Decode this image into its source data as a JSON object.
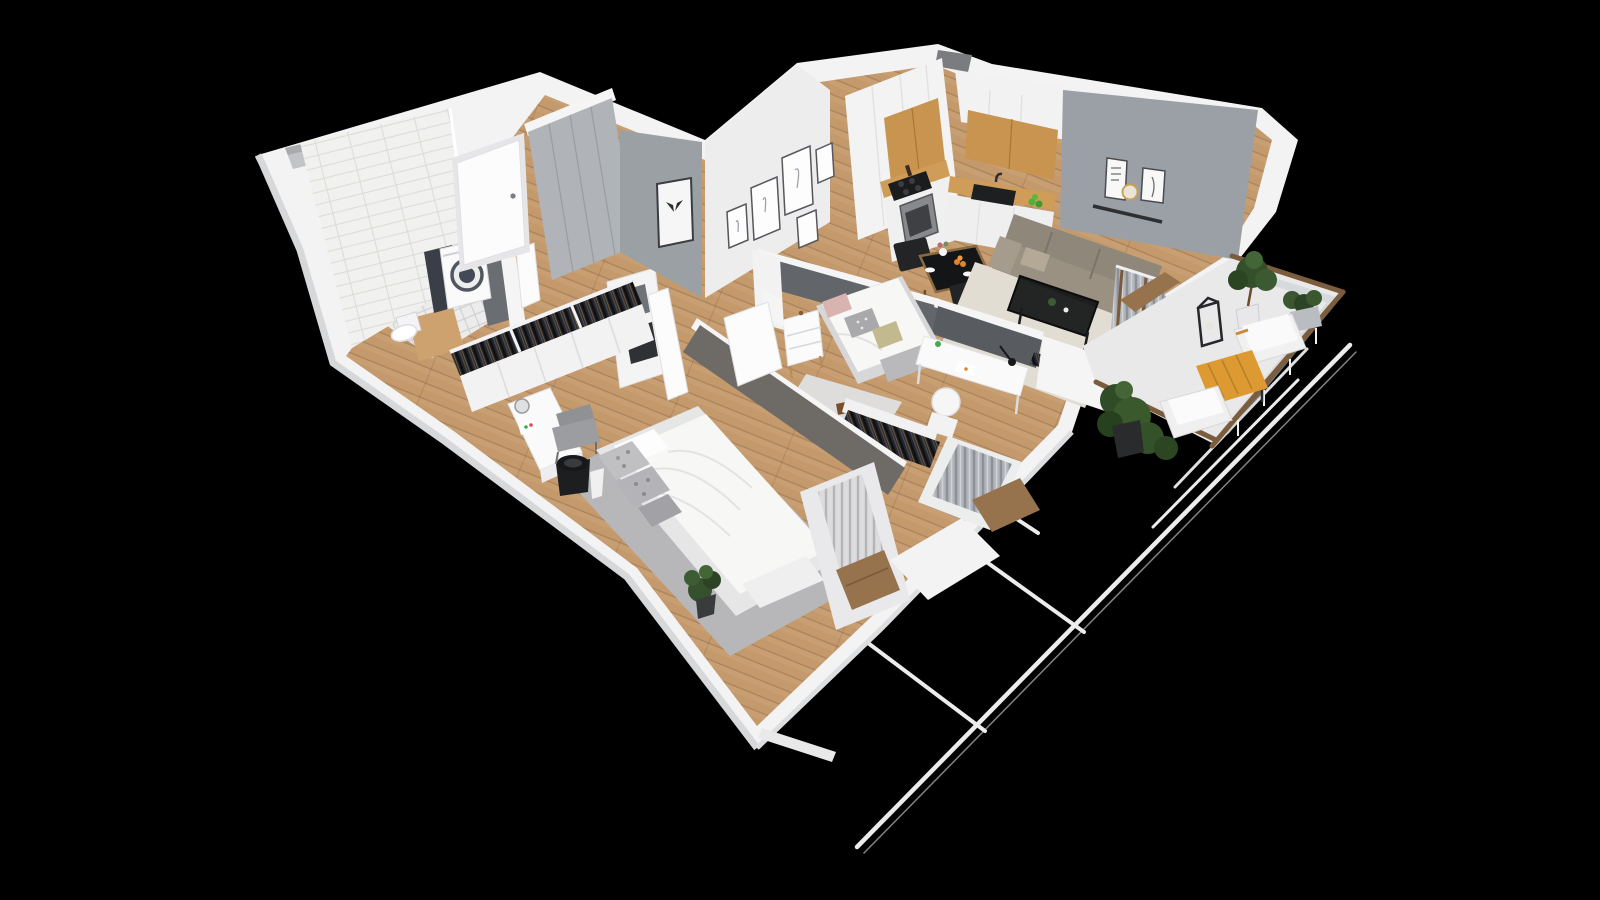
{
  "meta": {
    "description": "3D isometric cutaway render of a one-bedroom apartment floor plan on a black background, viewed from above",
    "canvas": {
      "width": 1600,
      "height": 900
    }
  },
  "palette": {
    "bg": "#000000",
    "wall": "#f3f3f4",
    "wallShade": "#d7d8da",
    "wallEdge": "#c6c7ca",
    "grayWall": "#9aa0a6",
    "darkWall": "#62666b",
    "darkWall2": "#6e6a66",
    "wood": "#c49a6c",
    "woodDark": "#9c7a54",
    "tile": "#f1f1ef",
    "bathFloor": "#ececec",
    "kitchenWood": "#c8944f",
    "counterWood": "#cf9d58",
    "applianceDark": "#1b1c1e",
    "sofa": "#8f8779",
    "rugCream": "#e2ddd3",
    "rugGray": "#b7b7b9",
    "rugLight": "#dedddb",
    "bedWhite": "#f7f7f6",
    "bedBase": "#e6e6e7",
    "pillowPink": "#d9b3b0",
    "pillowOlive": "#c3b98f",
    "pillowGray": "#c0c0c3",
    "clothesDark": "#23242a",
    "chairDark": "#232426",
    "chairGray": "#8f9195",
    "plantGreen": "#3a5a2e",
    "plantDark": "#2c4523",
    "tableOrange": "#dd9a33",
    "railWood": "#7b5c3c",
    "glass": "#c9ced2",
    "lineWhite": "#ececec",
    "doorWhite": "#fcfcfd",
    "woodSill": "#96734c"
  },
  "scene": {
    "rooms": [
      {
        "name": "bathroom",
        "features": [
          "subway-tile-wall",
          "diamond-tile-floor",
          "washing-machine",
          "toilet",
          "wood-vanity-counter",
          "open-door"
        ]
      },
      {
        "name": "entrance-hall",
        "features": [
          "front-door",
          "gray-wardrobe",
          "storage-cabinet-with-boxes",
          "open-cabinet-door"
        ]
      },
      {
        "name": "corridor",
        "features": [
          "open-closet-hanging-clothes",
          "white-closet-doors",
          "wood-plank-floor"
        ]
      },
      {
        "name": "kitchen",
        "features": [
          "tall-white-cabinets",
          "oak-upper-cabinets",
          "black-cooktop",
          "oven",
          "black-sink",
          "oak-countertop",
          "green-fruit-bowl"
        ]
      },
      {
        "name": "dining-area",
        "features": [
          "black-glass-table-wood-frame",
          "two-dark-chairs",
          "flower-vase",
          "orange-fruit-bowl"
        ]
      },
      {
        "name": "living-room",
        "features": [
          "gray-accent-wall",
          "wall-shelf-with-two-art-frames",
          "gold-round-decor",
          "beige-three-seat-sofa",
          "black-metal-coffee-table",
          "cream-rug",
          "curtained-balcony-door"
        ]
      },
      {
        "name": "small-bedroom",
        "features": [
          "gallery-wall-five-frames",
          "butterfly-frame",
          "single-bed",
          "pink-gray-olive-pillows",
          "white-nightstand",
          "white-desk",
          "black-desk-lamp",
          "white-round-chair",
          "light-rug",
          "dog-figurine",
          "open-clothes-rack",
          "curtained-window-bay"
        ]
      },
      {
        "name": "master-bedroom",
        "features": [
          "double-bed-white-duvet",
          "patterned-gray-pillows",
          "foot-bench",
          "gray-rug",
          "vanity-desk",
          "round-mirror",
          "gray-chair",
          "black-planter-bucket",
          "green-plant",
          "radiator-window-bay"
        ]
      },
      {
        "name": "balcony",
        "features": [
          "wood-glass-railing",
          "potted-tree",
          "black-lantern",
          "planter-bush",
          "two-white-benches",
          "orange-wood-table",
          "large-leafy-plants"
        ]
      }
    ],
    "exterior": [
      "black-background",
      "white-outer-walls",
      "two-shaft-notches",
      "neighbor-balcony-white-wireframe-rails"
    ]
  }
}
